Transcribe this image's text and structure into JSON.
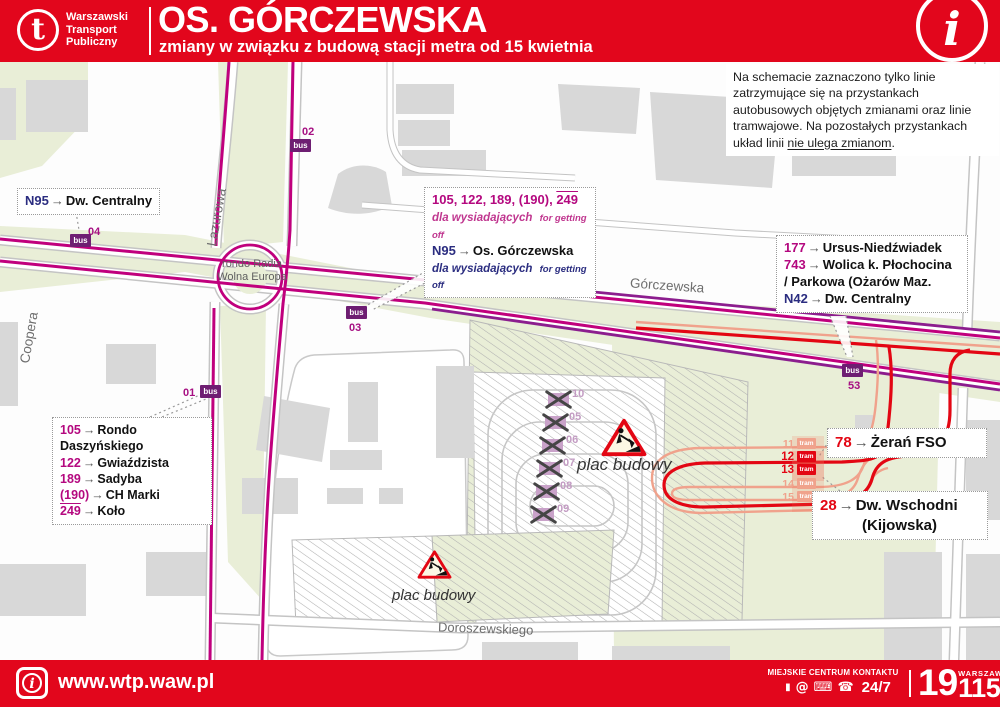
{
  "header": {
    "brand": [
      "Warszawski",
      "Transport",
      "Publiczny"
    ],
    "title": "OS. GÓRCZEWSKA",
    "subtitle": "zmiany w związku z budową stacji metra od 15 kwietnia",
    "info_glyph": "i"
  },
  "note": {
    "text": "Na schemacie zaznaczono tylko linie zatrzymujące się na przystankach autobusowych objętych zmianami oraz linie tramwajowe. Na pozostałych przystankach układ linii ",
    "underlined": "nie ulega zmianom",
    "suffix": "."
  },
  "map": {
    "streets": {
      "lazurowa": "Lazurowa",
      "coopera": "Coopera",
      "gorczewska": "Górczewska",
      "doroszewskiego": "Doroszewskiego",
      "rondo_line1": "rondo Radia",
      "rondo_line2": "Wolna Europa"
    },
    "construction_label": "plac budowy",
    "badge_bus": "bus",
    "badge_tram": "tram",
    "bus_stops": [
      {
        "number": "04"
      },
      {
        "number": "02"
      },
      {
        "number": "03"
      },
      {
        "number": "01"
      },
      {
        "number": "53"
      }
    ],
    "tram_stops": [
      {
        "number": "11"
      },
      {
        "number": "12"
      },
      {
        "number": "13"
      },
      {
        "number": "14"
      },
      {
        "number": "15"
      }
    ],
    "closed_stops": [
      {
        "number": "10"
      },
      {
        "number": "05"
      },
      {
        "number": "06"
      },
      {
        "number": "07"
      },
      {
        "number": "08"
      },
      {
        "number": "09"
      }
    ]
  },
  "callouts": {
    "n95_west": {
      "route": "N95",
      "arrow": "→",
      "dest": "Dw. Centralny"
    },
    "center": {
      "line1_pre": "105, 122, 189, (190), ",
      "line1_overlined": "249",
      "note_pl": "dla wysiadających",
      "note_en": "for getting off",
      "route": "N95",
      "arrow": "→",
      "dest": "Os. Górczewska",
      "note2_pl": "dla wysiadających",
      "note2_en": "for getting off"
    },
    "east": {
      "rows": [
        {
          "route": "177",
          "arrow": "→",
          "dest": "Ursus-Niedźwiadek"
        },
        {
          "route": "743",
          "arrow": "→",
          "dest": "Wolica k. Płochocina"
        },
        {
          "cont": "/ Parkowa (Ożarów Maz."
        },
        {
          "route": "N42",
          "arrow": "→",
          "dest": "Dw. Centralny"
        }
      ]
    },
    "southwest": {
      "rows": [
        {
          "route": "105",
          "arrow": "→",
          "dest": "Rondo Daszyńskiego"
        },
        {
          "route": "122",
          "arrow": "→",
          "dest": "Gwiaździsta"
        },
        {
          "route": "189",
          "arrow": "→",
          "dest": "Sadyba"
        },
        {
          "route": "(190)",
          "arrow": "→",
          "dest": "CH Marki"
        },
        {
          "route": "249",
          "arrow": "→",
          "dest": "Koło"
        }
      ]
    },
    "tram78": {
      "route": "78",
      "arrow": "→",
      "dest": "Żerań FSO"
    },
    "tram28": {
      "route": "28",
      "arrow": "→",
      "dest": "Dw. Wschodni",
      "dest2": "(Kijowska)"
    }
  },
  "footer": {
    "info_glyph": "i",
    "url": "www.wtp.waw.pl",
    "contact_label": "MIEJSKIE CENTRUM KONTAKTU",
    "icons": {
      "mobile": "▮",
      "at": "@",
      "desktop": "⌨",
      "phone": "☎"
    },
    "hours": "24/7",
    "phone_prefix": "19",
    "city": "WARSZAWA",
    "phone_suffix": "115"
  },
  "colors": {
    "wtp_red": "#e2061c",
    "bus_magenta": "#c0007d",
    "night_violet": "#8c1d8e",
    "night_navy": "#2b2d80",
    "tram_red": "#e30613",
    "tram_inactive": "#f0a28c",
    "closed_purple": "#c9a2c9",
    "green_area": "#e9eed7"
  }
}
